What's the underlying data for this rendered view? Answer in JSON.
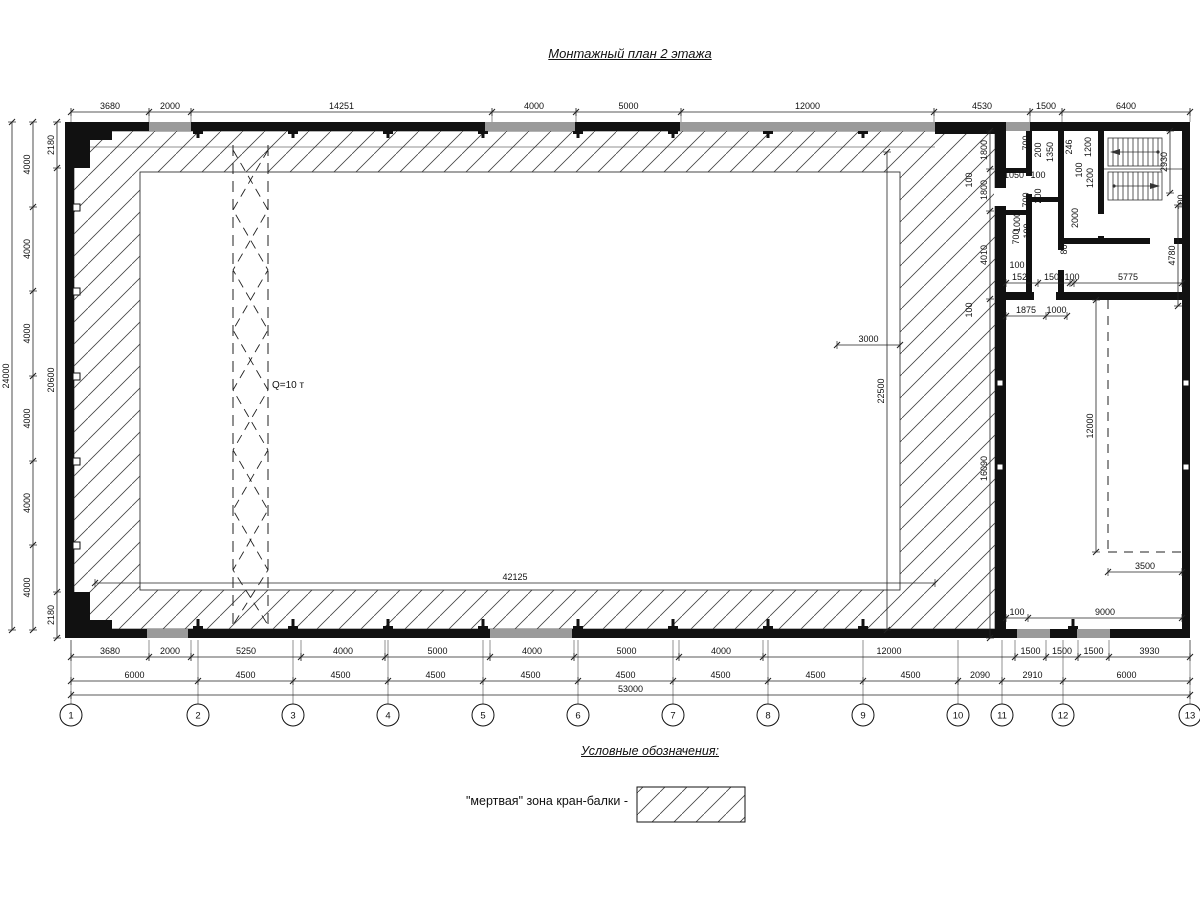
{
  "title": "Монтажный план 2 этажа",
  "crane": {
    "capacity_label": "Q=10 т"
  },
  "legend": {
    "heading": "Условные обозначения:",
    "item_label": "\"мертвая\" зона кран-балки -"
  },
  "grid_bubbles": {
    "y": 715,
    "r": 11,
    "items": [
      {
        "n": "1",
        "x": 71
      },
      {
        "n": "2",
        "x": 198
      },
      {
        "n": "3",
        "x": 293
      },
      {
        "n": "4",
        "x": 388
      },
      {
        "n": "5",
        "x": 483
      },
      {
        "n": "6",
        "x": 578
      },
      {
        "n": "7",
        "x": 673
      },
      {
        "n": "8",
        "x": 768
      },
      {
        "n": "9",
        "x": 863
      },
      {
        "n": "10",
        "x": 958
      },
      {
        "n": "11",
        "x": 1002
      },
      {
        "n": "12",
        "x": 1063
      },
      {
        "n": "13",
        "x": 1190
      }
    ]
  },
  "dimensions": {
    "h_rows": [
      {
        "y": 112,
        "e": [
          108,
          122
        ],
        "b": [
          71,
          149,
          191,
          492,
          576,
          681,
          934,
          1030,
          1062,
          1190
        ],
        "l": [
          "3680",
          "2000",
          "14251",
          "4000",
          "5000",
          "12000",
          "4530",
          "1500",
          "6400"
        ]
      },
      {
        "y": 657,
        "e": [
          640,
          661
        ],
        "b": [
          71,
          149,
          191,
          301,
          385,
          490,
          574,
          679,
          763,
          1015,
          1046,
          1078,
          1109,
          1190
        ],
        "l": [
          "3680",
          "2000",
          "5250",
          "4000",
          "5000",
          "4000",
          "5000",
          "4000",
          "12000",
          "1500",
          "1500",
          "1500",
          "3930"
        ]
      },
      {
        "y": 681,
        "b": [
          71,
          198,
          293,
          388,
          483,
          578,
          673,
          768,
          863,
          958,
          1002,
          1063,
          1190
        ],
        "l": [
          "6000",
          "4500",
          "4500",
          "4500",
          "4500",
          "4500",
          "4500",
          "4500",
          "4500",
          "2090",
          "2910",
          "6000"
        ]
      },
      {
        "y": 695,
        "b": [
          71,
          1190
        ],
        "l": [
          "53000"
        ]
      },
      {
        "y": 283,
        "b": [
          1006,
          1038,
          1070,
          1074,
          1182
        ],
        "l": [
          "1525",
          "1500",
          "100",
          "5775"
        ]
      },
      {
        "y": 316,
        "b": [
          1006,
          1046,
          1067
        ],
        "l": [
          "1875",
          "1000"
        ]
      },
      {
        "y": 618,
        "b": [
          1006,
          1028,
          1182
        ],
        "l": [
          "100",
          "9000"
        ]
      },
      {
        "y": 345,
        "b": [
          837,
          900
        ],
        "l": [
          "3000"
        ]
      },
      {
        "y": 583,
        "b": [
          95,
          935
        ],
        "l": [
          "42125"
        ]
      },
      {
        "y": 572,
        "b": [
          1108,
          1182
        ],
        "l": [
          "3500"
        ]
      }
    ],
    "v_cols": [
      {
        "x": 57,
        "b": [
          122,
          168,
          592,
          638
        ],
        "l": [
          "2180",
          "20600",
          "2180"
        ]
      },
      {
        "x": 33,
        "b": [
          122,
          207,
          291,
          376,
          461,
          545,
          630
        ],
        "l": [
          "4000",
          "4000",
          "4000",
          "4000",
          "4000",
          "4000"
        ]
      },
      {
        "x": 12,
        "b": [
          122,
          630
        ],
        "l": [
          "24000"
        ]
      },
      {
        "x": 990,
        "b": [
          131,
          169,
          211,
          299,
          638
        ],
        "l": [
          "1800",
          "1800",
          "4010",
          "16090"
        ]
      },
      {
        "x": 1096,
        "b": [
          300,
          552
        ],
        "l": [
          "12000"
        ]
      },
      {
        "x": 887,
        "b": [
          152,
          630
        ],
        "l": [
          "22500"
        ]
      },
      {
        "x": 1170,
        "b": [
          131,
          193
        ],
        "l": [
          "2930"
        ]
      },
      {
        "x": 1178,
        "b": [
          205,
          306
        ],
        "l": [
          "4780"
        ]
      }
    ],
    "free_labels": [
      {
        "t": "100",
        "x": 972,
        "y": 180,
        "v": 1
      },
      {
        "t": "100",
        "x": 972,
        "y": 310,
        "v": 1
      },
      {
        "t": "700",
        "x": 1029,
        "y": 143,
        "v": 1
      },
      {
        "t": "200",
        "x": 1041,
        "y": 150,
        "v": 1
      },
      {
        "t": "1350",
        "x": 1053,
        "y": 152,
        "v": 1
      },
      {
        "t": "246",
        "x": 1072,
        "y": 147,
        "v": 1
      },
      {
        "t": "1200",
        "x": 1091,
        "y": 147,
        "v": 1
      },
      {
        "t": "100",
        "x": 1082,
        "y": 170,
        "v": 1
      },
      {
        "t": "1200",
        "x": 1093,
        "y": 178,
        "v": 1
      },
      {
        "t": "100",
        "x": 1184,
        "y": 202,
        "v": 1
      },
      {
        "t": "1050",
        "x": 1014,
        "y": 178,
        "v": 0
      },
      {
        "t": "100",
        "x": 1038,
        "y": 178,
        "v": 0
      },
      {
        "t": "700",
        "x": 1029,
        "y": 200,
        "v": 1
      },
      {
        "t": "200",
        "x": 1041,
        "y": 196,
        "v": 1
      },
      {
        "t": "1000",
        "x": 1020,
        "y": 222,
        "v": 1
      },
      {
        "t": "2000",
        "x": 1078,
        "y": 218,
        "v": 1
      },
      {
        "t": "700",
        "x": 1019,
        "y": 237,
        "v": 1
      },
      {
        "t": "100",
        "x": 1030,
        "y": 231,
        "v": 1
      },
      {
        "t": "800",
        "x": 1067,
        "y": 247,
        "v": 1
      },
      {
        "t": "100",
        "x": 1017,
        "y": 268,
        "v": 0
      }
    ]
  },
  "colors": {
    "line": "#111111",
    "window_gray": "#9a9a9a",
    "hatch": "#444444"
  }
}
